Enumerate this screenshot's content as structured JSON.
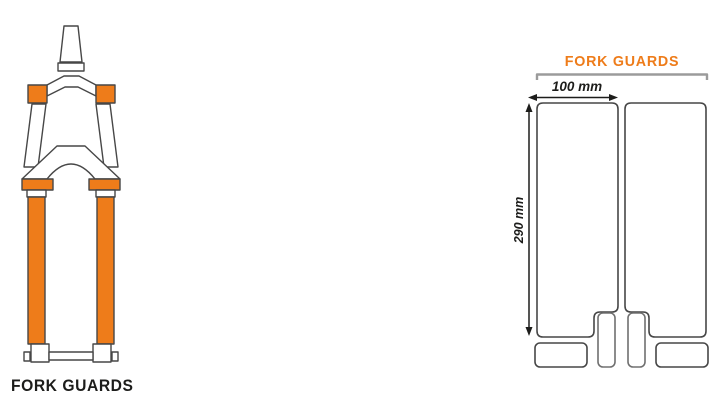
{
  "colors": {
    "accent_orange": "#ee7c1a",
    "outline_dark": "#474747",
    "strip_gray": "#707070",
    "bracket_gray": "#9b9b9b",
    "text_black": "#1d1d1b"
  },
  "fork_illustration": {
    "caption": "FORK GUARDS"
  },
  "guard_template": {
    "title": "FORK GUARDS",
    "width_label": "100 mm",
    "height_label": "290 mm"
  }
}
